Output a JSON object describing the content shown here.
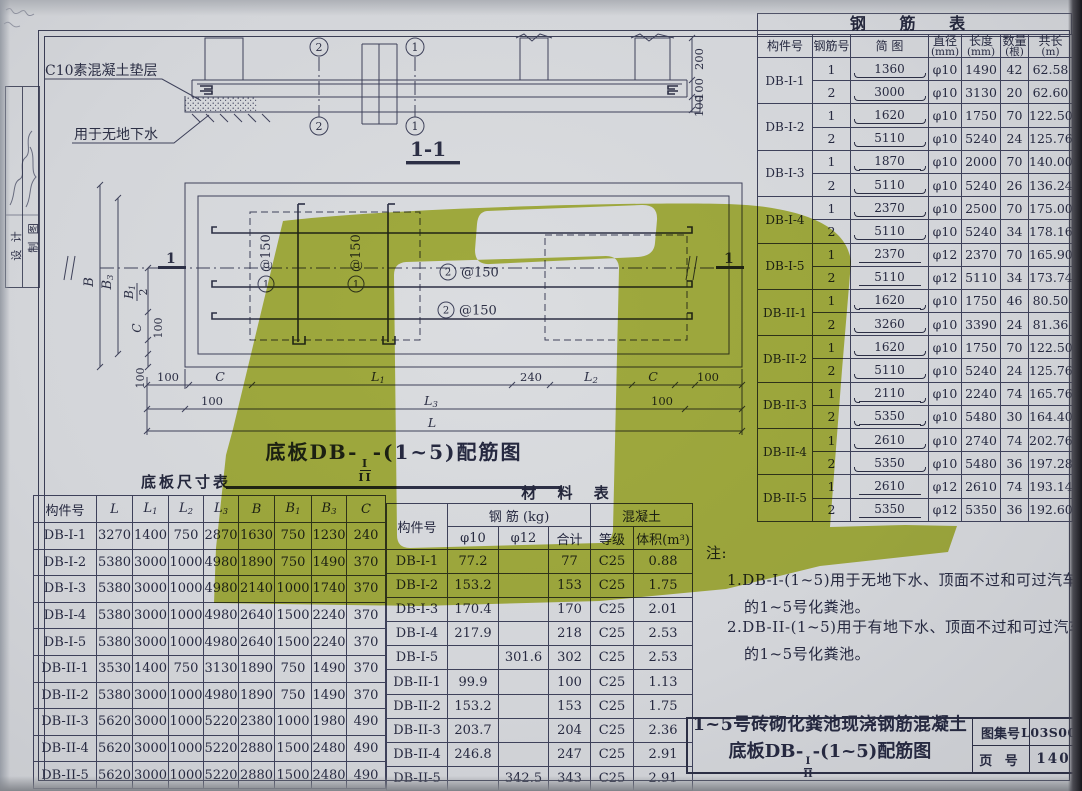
{
  "page": {
    "sheet_name": "1~5号砖砌化粪池现浇钢筋混凝土底板配筋图",
    "colors": {
      "watermark_green": "#a9b518",
      "paper": "#d3d5d9",
      "line": "#3e415a"
    }
  },
  "sidebar": {
    "design_label": "设 计",
    "draft_label": "制 图"
  },
  "section_view": {
    "label": "1-1",
    "bedding_note": "C10素混凝土垫层",
    "usage_note": "用于无地下水",
    "axis_2": "2",
    "axis_1": "1",
    "dim_200": "200",
    "dim_100": "100"
  },
  "plan_view": {
    "title_prefix": "底板DB-",
    "frac_top": "I",
    "frac_bot": "II",
    "title_suffix": "-(1~5)配筋图",
    "bar1_no": "1",
    "bar1_spacing": "@150",
    "bar2_no": "2",
    "bar2_spacing": "@150",
    "section_mark": "1",
    "dim_B": "B",
    "dim_B3_base": "B",
    "dim_B3_sub": "3",
    "dim_B1_base": "B",
    "dim_B1_sub": "1",
    "dim_B1_den": "2",
    "dim_C": "C",
    "dim_100": "100",
    "dim_240": "240",
    "dim_L1_base": "L",
    "dim_L1_sub": "1",
    "dim_L2_base": "L",
    "dim_L2_sub": "2",
    "dim_L3_base": "L",
    "dim_L3_sub": "3",
    "dim_L": "L"
  },
  "rebar_table": {
    "title": "钢 筋 表",
    "col_member": "构件号",
    "col_barno": "钢筋号",
    "col_sketch": "简 图",
    "col_dia": "直径",
    "col_dia_u": "(mm)",
    "col_len": "长度",
    "col_len_u": "(mm)",
    "col_qty": "数量",
    "col_qty_u": "(根)",
    "col_total": "共长",
    "col_total_u": "(m)",
    "groups": [
      {
        "member": "DB-I-1",
        "rows": [
          {
            "no": "1",
            "sketch": "1360",
            "hooks": true,
            "dia": "φ10",
            "len": "1490",
            "qty": "42",
            "total": "62.58"
          },
          {
            "no": "2",
            "sketch": "3000",
            "hooks": true,
            "dia": "φ10",
            "len": "3130",
            "qty": "20",
            "total": "62.60"
          }
        ]
      },
      {
        "member": "DB-I-2",
        "rows": [
          {
            "no": "1",
            "sketch": "1620",
            "hooks": true,
            "dia": "φ10",
            "len": "1750",
            "qty": "70",
            "total": "122.50"
          },
          {
            "no": "2",
            "sketch": "5110",
            "hooks": true,
            "dia": "φ10",
            "len": "5240",
            "qty": "24",
            "total": "125.76"
          }
        ]
      },
      {
        "member": "DB-I-3",
        "rows": [
          {
            "no": "1",
            "sketch": "1870",
            "hooks": true,
            "dia": "φ10",
            "len": "2000",
            "qty": "70",
            "total": "140.00"
          },
          {
            "no": "2",
            "sketch": "5110",
            "hooks": true,
            "dia": "φ10",
            "len": "5240",
            "qty": "26",
            "total": "136.24"
          }
        ]
      },
      {
        "member": "DB-I-4",
        "rows": [
          {
            "no": "1",
            "sketch": "2370",
            "hooks": true,
            "dia": "φ10",
            "len": "2500",
            "qty": "70",
            "total": "175.00"
          },
          {
            "no": "2",
            "sketch": "5110",
            "hooks": true,
            "dia": "φ10",
            "len": "5240",
            "qty": "34",
            "total": "178.16"
          }
        ]
      },
      {
        "member": "DB-I-5",
        "rows": [
          {
            "no": "1",
            "sketch": "2370",
            "hooks": false,
            "dia": "φ12",
            "len": "2370",
            "qty": "70",
            "total": "165.90"
          },
          {
            "no": "2",
            "sketch": "5110",
            "hooks": false,
            "dia": "φ12",
            "len": "5110",
            "qty": "34",
            "total": "173.74"
          }
        ]
      },
      {
        "member": "DB-II-1",
        "rows": [
          {
            "no": "1",
            "sketch": "1620",
            "hooks": true,
            "dia": "φ10",
            "len": "1750",
            "qty": "46",
            "total": "80.50"
          },
          {
            "no": "2",
            "sketch": "3260",
            "hooks": true,
            "dia": "φ10",
            "len": "3390",
            "qty": "24",
            "total": "81.36"
          }
        ]
      },
      {
        "member": "DB-II-2",
        "rows": [
          {
            "no": "1",
            "sketch": "1620",
            "hooks": true,
            "dia": "φ10",
            "len": "1750",
            "qty": "70",
            "total": "122.50"
          },
          {
            "no": "2",
            "sketch": "5110",
            "hooks": true,
            "dia": "φ10",
            "len": "5240",
            "qty": "24",
            "total": "125.76"
          }
        ]
      },
      {
        "member": "DB-II-3",
        "rows": [
          {
            "no": "1",
            "sketch": "2110",
            "hooks": true,
            "dia": "φ10",
            "len": "2240",
            "qty": "74",
            "total": "165.76"
          },
          {
            "no": "2",
            "sketch": "5350",
            "hooks": true,
            "dia": "φ10",
            "len": "5480",
            "qty": "30",
            "total": "164.40"
          }
        ]
      },
      {
        "member": "DB-II-4",
        "rows": [
          {
            "no": "1",
            "sketch": "2610",
            "hooks": true,
            "dia": "φ10",
            "len": "2740",
            "qty": "74",
            "total": "202.76"
          },
          {
            "no": "2",
            "sketch": "5350",
            "hooks": true,
            "dia": "φ10",
            "len": "5480",
            "qty": "36",
            "total": "197.28"
          }
        ]
      },
      {
        "member": "DB-II-5",
        "rows": [
          {
            "no": "1",
            "sketch": "2610",
            "hooks": false,
            "dia": "φ12",
            "len": "2610",
            "qty": "74",
            "total": "193.14"
          },
          {
            "no": "2",
            "sketch": "5350",
            "hooks": false,
            "dia": "φ12",
            "len": "5350",
            "qty": "36",
            "total": "192.60"
          }
        ]
      }
    ]
  },
  "dims_table": {
    "title": "底板尺寸表",
    "col_member": "构件号",
    "cols": [
      {
        "b": "L",
        "s": ""
      },
      {
        "b": "L",
        "s": "1"
      },
      {
        "b": "L",
        "s": "2"
      },
      {
        "b": "L",
        "s": "3"
      },
      {
        "b": "B",
        "s": ""
      },
      {
        "b": "B",
        "s": "1"
      },
      {
        "b": "B",
        "s": "3"
      },
      {
        "b": "C",
        "s": ""
      }
    ],
    "rows": [
      {
        "member": "DB-I-1",
        "values": [
          "3270",
          "1400",
          "750",
          "2870",
          "1630",
          "750",
          "1230",
          "240"
        ]
      },
      {
        "member": "DB-I-2",
        "values": [
          "5380",
          "3000",
          "1000",
          "4980",
          "1890",
          "750",
          "1490",
          "370"
        ]
      },
      {
        "member": "DB-I-3",
        "values": [
          "5380",
          "3000",
          "1000",
          "4980",
          "2140",
          "1000",
          "1740",
          "370"
        ]
      },
      {
        "member": "DB-I-4",
        "values": [
          "5380",
          "3000",
          "1000",
          "4980",
          "2640",
          "1500",
          "2240",
          "370"
        ]
      },
      {
        "member": "DB-I-5",
        "values": [
          "5380",
          "3000",
          "1000",
          "4980",
          "2640",
          "1500",
          "2240",
          "370"
        ]
      },
      {
        "member": "DB-II-1",
        "values": [
          "3530",
          "1400",
          "750",
          "3130",
          "1890",
          "750",
          "1490",
          "370"
        ]
      },
      {
        "member": "DB-II-2",
        "values": [
          "5380",
          "3000",
          "1000",
          "4980",
          "1890",
          "750",
          "1490",
          "370"
        ]
      },
      {
        "member": "DB-II-3",
        "values": [
          "5620",
          "3000",
          "1000",
          "5220",
          "2380",
          "1000",
          "1980",
          "490"
        ]
      },
      {
        "member": "DB-II-4",
        "values": [
          "5620",
          "3000",
          "1000",
          "5220",
          "2880",
          "1500",
          "2480",
          "490"
        ]
      },
      {
        "member": "DB-II-5",
        "values": [
          "5620",
          "3000",
          "1000",
          "5220",
          "2880",
          "1500",
          "2480",
          "490"
        ]
      }
    ]
  },
  "material_table": {
    "title": "材 料 表",
    "col_member": "构件号",
    "group_steel": "钢 筋 (kg)",
    "group_conc": "混凝土",
    "col_d10": "φ10",
    "col_d12": "φ12",
    "col_sum": "合计",
    "col_grade": "等级",
    "col_vol": "体积(m³)",
    "rows": [
      {
        "member": "DB-I-1",
        "d10": "77.2",
        "d12": "",
        "sum": "77",
        "grade": "C25",
        "vol": "0.88"
      },
      {
        "member": "DB-I-2",
        "d10": "153.2",
        "d12": "",
        "sum": "153",
        "grade": "C25",
        "vol": "1.75"
      },
      {
        "member": "DB-I-3",
        "d10": "170.4",
        "d12": "",
        "sum": "170",
        "grade": "C25",
        "vol": "2.01"
      },
      {
        "member": "DB-I-4",
        "d10": "217.9",
        "d12": "",
        "sum": "218",
        "grade": "C25",
        "vol": "2.53"
      },
      {
        "member": "DB-I-5",
        "d10": "",
        "d12": "301.6",
        "sum": "302",
        "grade": "C25",
        "vol": "2.53"
      },
      {
        "member": "DB-II-1",
        "d10": "99.9",
        "d12": "",
        "sum": "100",
        "grade": "C25",
        "vol": "1.13"
      },
      {
        "member": "DB-II-2",
        "d10": "153.2",
        "d12": "",
        "sum": "153",
        "grade": "C25",
        "vol": "1.75"
      },
      {
        "member": "DB-II-3",
        "d10": "203.7",
        "d12": "",
        "sum": "204",
        "grade": "C25",
        "vol": "2.36"
      },
      {
        "member": "DB-II-4",
        "d10": "246.8",
        "d12": "",
        "sum": "247",
        "grade": "C25",
        "vol": "2.91"
      },
      {
        "member": "DB-II-5",
        "d10": "",
        "d12": "342.5",
        "sum": "343",
        "grade": "C25",
        "vol": "2.91"
      }
    ]
  },
  "notes": {
    "label": "注:",
    "item1_line1": "1.DB-I-(1~5)用于无地下水、顶面不过和可过汽车",
    "item1_line2": "的1~5号化粪池。",
    "item2_line1": "2.DB-II-(1~5)用于有地下水、顶面不过和可过汽车",
    "item2_line2": "的1~5号化粪池。"
  },
  "title_block": {
    "title_line1": "1~5号砖砌化粪池现浇钢筋混凝土",
    "title2_prefix": "底板DB-",
    "title2_frac_top": "I",
    "title2_frac_bot": "II",
    "title2_suffix": "-(1~5)配筋图",
    "atlas_label": "图集号",
    "atlas_no": "L03S002",
    "page_label": "页 号",
    "page_no": "140"
  }
}
